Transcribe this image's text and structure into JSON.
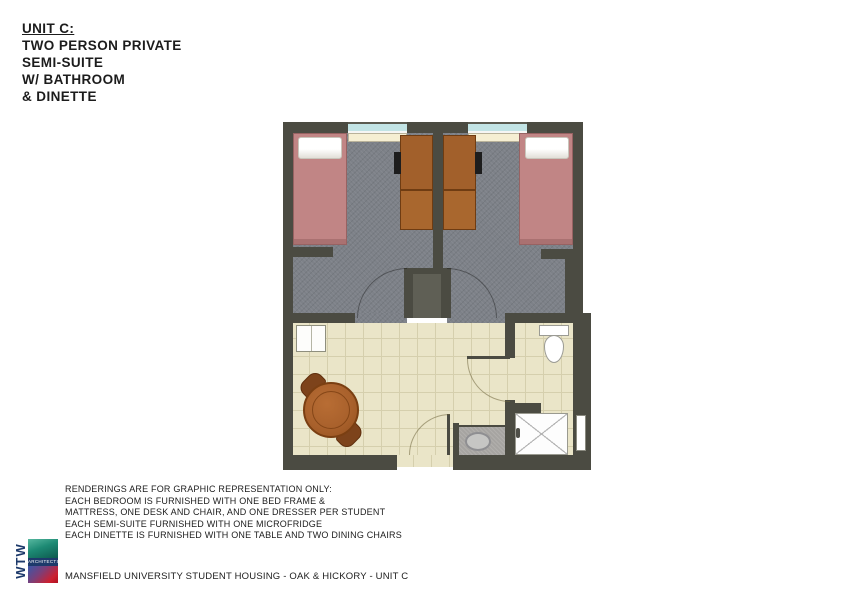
{
  "title": {
    "lines": [
      "UNIT C:",
      "TWO PERSON PRIVATE",
      "SEMI-SUITE",
      "W/ BATHROOM",
      "& DINETTE"
    ]
  },
  "disclaimer": {
    "lines": [
      "RENDERINGS ARE FOR GRAPHIC REPRESENTATION ONLY:",
      "EACH BEDROOM IS FURNISHED WITH ONE BED FRAME &",
      "MATTRESS, ONE DESK AND CHAIR, AND ONE DRESSER PER STUDENT",
      "EACH SEMI-SUITE FURNISHED WITH ONE MICROFRIDGE",
      "EACH DINETTE IS FURNISHED WITH ONE TABLE AND TWO DINING CHAIRS"
    ]
  },
  "footer": {
    "text": "MANSFIELD UNIVERSITY STUDENT HOUSING - OAK & HICKORY - UNIT C"
  },
  "logo": {
    "letters": "WTW",
    "label": "ARCHITECTS"
  },
  "floorplan": {
    "colors": {
      "wall": "#4b4b42",
      "carpet": "#7d8188",
      "tile": "#eae5c8",
      "bed": "#c18585",
      "wood_furniture": "#a2602b",
      "window_glass": "#c2e4e5",
      "window_sill": "#f6efd3",
      "fixture_white": "#fdfdfb",
      "vanity_counter": "#a6a4a1"
    }
  }
}
